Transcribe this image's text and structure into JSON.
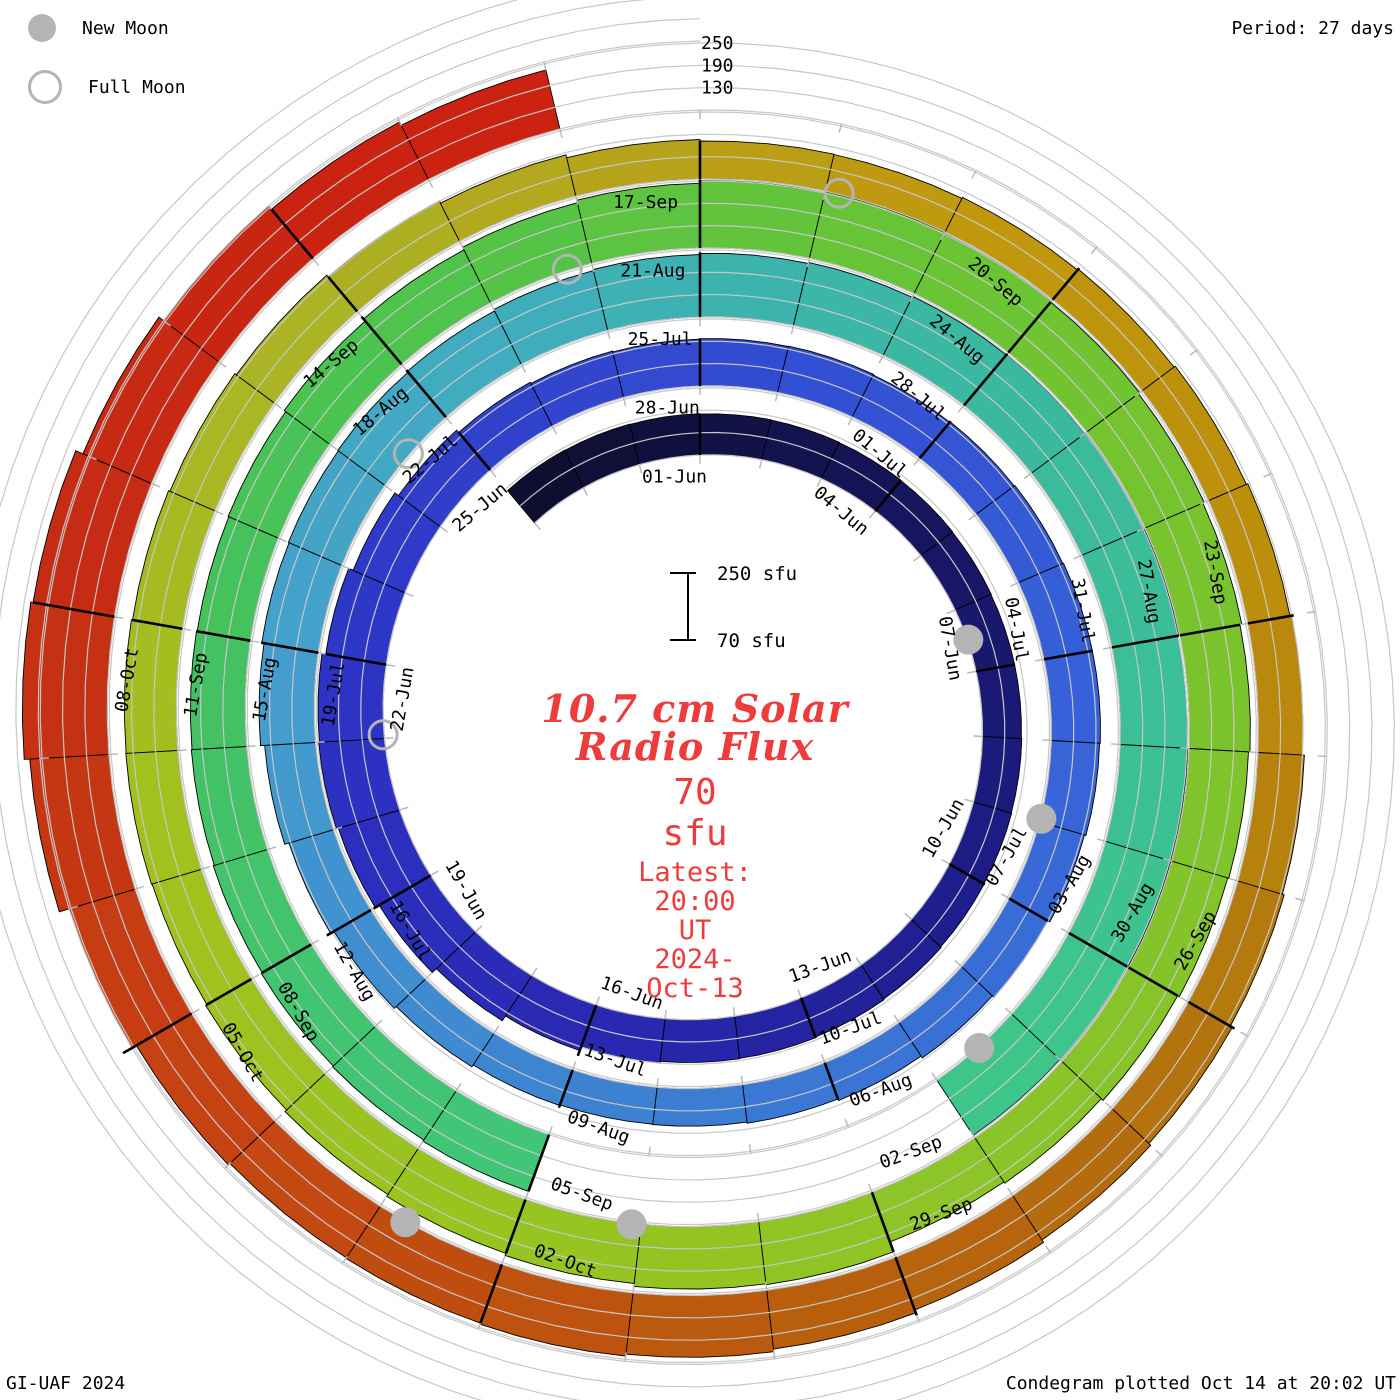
{
  "legend": {
    "new_moon": "New Moon",
    "full_moon": "Full Moon"
  },
  "header": {
    "period": "Period: 27 days"
  },
  "footer": {
    "left": "GI-UAF 2024",
    "right": "Condegram plotted Oct 14 at 20:02 UT"
  },
  "center": {
    "title_line1": "10.7 cm Solar",
    "title_line2": "Radio Flux",
    "value": "70 sfu",
    "latest_line1": "Latest: 20:00 UT",
    "latest_line2": "2024-Oct-13"
  },
  "scalebar": {
    "top_label": "250 sfu",
    "bottom_label": "70 sfu"
  },
  "chart_data": {
    "type": "spiral_condegram",
    "title": "10.7 cm Solar Radio Flux",
    "period_days": 27,
    "radial_base_sfu": 70,
    "radial_gridlines_sfu": [
      130,
      190,
      250
    ],
    "radial_axis_labels": [
      "250",
      "190",
      "130"
    ],
    "start_date": "2024-05-29",
    "end_date": "2024-10-13",
    "flux_units": "sfu",
    "flux_by_day": [
      183,
      182,
      181,
      180,
      179,
      178,
      177,
      176,
      175,
      175,
      176,
      177,
      178,
      180,
      182,
      184,
      185,
      190,
      200,
      215,
      230,
      242,
      247,
      245,
      235,
      222,
      210,
      202,
      198,
      196,
      197,
      198,
      196,
      198,
      200,
      202,
      202,
      200,
      196,
      190,
      184,
      178,
      174,
      171,
      170,
      172,
      178,
      185,
      195,
      207,
      218,
      224,
      226,
      228,
      231,
      235,
      238,
      241,
      244,
      247,
      249,
      251,
      252,
      250,
      252,
      253,
      251,
      248,
      null,
      null,
      null,
      null,
      232,
      228,
      225,
      222,
      219,
      217,
      215,
      217,
      222,
      229,
      237,
      244,
      251,
      254,
      251,
      247,
      243,
      239,
      234,
      230,
      227,
      222,
      216,
      212,
      240,
      238,
      230,
      224,
      218,
      212,
      208,
      210,
      209,
      206,
      202,
      197,
      191,
      184,
      176,
      172,
      171,
      174,
      177,
      181,
      185,
      190,
      195,
      200,
      206,
      213,
      221,
      229,
      236,
      241,
      238,
      236,
      242,
      255,
      283,
      298,
      292,
      271,
      255,
      243,
      233
    ],
    "data_gap_dates": [
      "2024-08-06",
      "2024-08-07",
      "2024-08-08",
      "2024-08-09"
    ],
    "day_labels": [
      {
        "d": 0,
        "text": "01-Jun"
      },
      {
        "d": 3,
        "text": "04-Jun"
      },
      {
        "d": 6,
        "text": "07-Jun"
      },
      {
        "d": 9,
        "text": "10-Jun"
      },
      {
        "d": 12,
        "text": "13-Jun"
      },
      {
        "d": 15,
        "text": "16-Jun"
      },
      {
        "d": 18,
        "text": "19-Jun"
      },
      {
        "d": 21,
        "text": "22-Jun"
      },
      {
        "d": 24,
        "text": "25-Jun"
      },
      {
        "d": 27,
        "text": "28-Jun"
      },
      {
        "d": 30,
        "text": "01-Jul"
      },
      {
        "d": 33,
        "text": "04-Jul"
      },
      {
        "d": 36,
        "text": "07-Jul"
      },
      {
        "d": 39,
        "text": "10-Jul"
      },
      {
        "d": 42,
        "text": "13-Jul"
      },
      {
        "d": 45,
        "text": "16-Jul"
      },
      {
        "d": 48,
        "text": "19-Jul"
      },
      {
        "d": 51,
        "text": "22-Jul"
      },
      {
        "d": 54,
        "text": "25-Jul"
      },
      {
        "d": 57,
        "text": "28-Jul"
      },
      {
        "d": 60,
        "text": "31-Jul"
      },
      {
        "d": 63,
        "text": "03-Aug"
      },
      {
        "d": 66,
        "text": "06-Aug"
      },
      {
        "d": 69,
        "text": "09-Aug"
      },
      {
        "d": 72,
        "text": "12-Aug"
      },
      {
        "d": 75,
        "text": "15-Aug"
      },
      {
        "d": 78,
        "text": "18-Aug"
      },
      {
        "d": 81,
        "text": "21-Aug"
      },
      {
        "d": 84,
        "text": "24-Aug"
      },
      {
        "d": 87,
        "text": "27-Aug"
      },
      {
        "d": 90,
        "text": "30-Aug"
      },
      {
        "d": 93,
        "text": "02-Sep"
      },
      {
        "d": 96,
        "text": "05-Sep"
      },
      {
        "d": 99,
        "text": "08-Sep"
      },
      {
        "d": 102,
        "text": "11-Sep"
      },
      {
        "d": 105,
        "text": "14-Sep"
      },
      {
        "d": 108,
        "text": "17-Sep"
      },
      {
        "d": 111,
        "text": "20-Sep"
      },
      {
        "d": 114,
        "text": "23-Sep"
      },
      {
        "d": 117,
        "text": "26-Sep"
      },
      {
        "d": 120,
        "text": "29-Sep"
      },
      {
        "d": 123,
        "text": "02-Oct"
      },
      {
        "d": 126,
        "text": "05-Oct"
      },
      {
        "d": 129,
        "text": "08-Oct"
      }
    ],
    "new_moons": [
      {
        "date": "2024-06-06",
        "d": 5.5
      },
      {
        "date": "2024-07-05",
        "d": 34.96
      },
      {
        "date": "2024-08-04",
        "d": 64.47
      },
      {
        "date": "2024-09-03",
        "d": 95.08
      },
      {
        "date": "2024-10-02",
        "d": 123.78
      }
    ],
    "full_moons": [
      {
        "date": "2024-06-21",
        "d": 20.05
      },
      {
        "date": "2024-07-21",
        "d": 50.43
      },
      {
        "date": "2024-08-19",
        "d": 79.77
      },
      {
        "date": "2024-09-18",
        "d": 109.11
      }
    ],
    "colors": {
      "moon_gray": "#b4b4b4",
      "gridline": "#c7c7c7",
      "tick": "#b5b5b5",
      "accent_red_text": "#ee3c3c",
      "colormap_anchors": [
        {
          "d": -3,
          "hex": "#0d0d2c"
        },
        {
          "d": 3,
          "hex": "#15155a"
        },
        {
          "d": 9,
          "hex": "#1d1d88"
        },
        {
          "d": 14,
          "hex": "#2727ae"
        },
        {
          "d": 19,
          "hex": "#2c2fc0"
        },
        {
          "d": 24,
          "hex": "#3040cb"
        },
        {
          "d": 29,
          "hex": "#3351d4"
        },
        {
          "d": 34,
          "hex": "#3763d8"
        },
        {
          "d": 39,
          "hex": "#3a76d3"
        },
        {
          "d": 44,
          "hex": "#3f8cd0"
        },
        {
          "d": 48,
          "hex": "#459fcc"
        },
        {
          "d": 52,
          "hex": "#40adbd"
        },
        {
          "d": 56,
          "hex": "#3bb7a4"
        },
        {
          "d": 61,
          "hex": "#3cbf94"
        },
        {
          "d": 66,
          "hex": "#3fc986"
        },
        {
          "d": 70,
          "hex": "#41c676"
        },
        {
          "d": 74,
          "hex": "#43c166"
        },
        {
          "d": 78,
          "hex": "#4cc34e"
        },
        {
          "d": 82,
          "hex": "#65c437"
        },
        {
          "d": 86,
          "hex": "#76c32e"
        },
        {
          "d": 91,
          "hex": "#88c42a"
        },
        {
          "d": 96,
          "hex": "#98c41f"
        },
        {
          "d": 101,
          "hex": "#a3bf1e"
        },
        {
          "d": 105,
          "hex": "#abb225"
        },
        {
          "d": 108,
          "hex": "#b8a019"
        },
        {
          "d": 110,
          "hex": "#c1980d"
        },
        {
          "d": 114,
          "hex": "#ba8c0b"
        },
        {
          "d": 117,
          "hex": "#b4760f"
        },
        {
          "d": 120,
          "hex": "#b6620e"
        },
        {
          "d": 123,
          "hex": "#bf500f"
        },
        {
          "d": 126,
          "hex": "#c63f13"
        },
        {
          "d": 129,
          "hex": "#c42e13"
        },
        {
          "d": 132,
          "hex": "#c92412"
        },
        {
          "d": 135,
          "hex": "#cf2011"
        }
      ]
    }
  }
}
